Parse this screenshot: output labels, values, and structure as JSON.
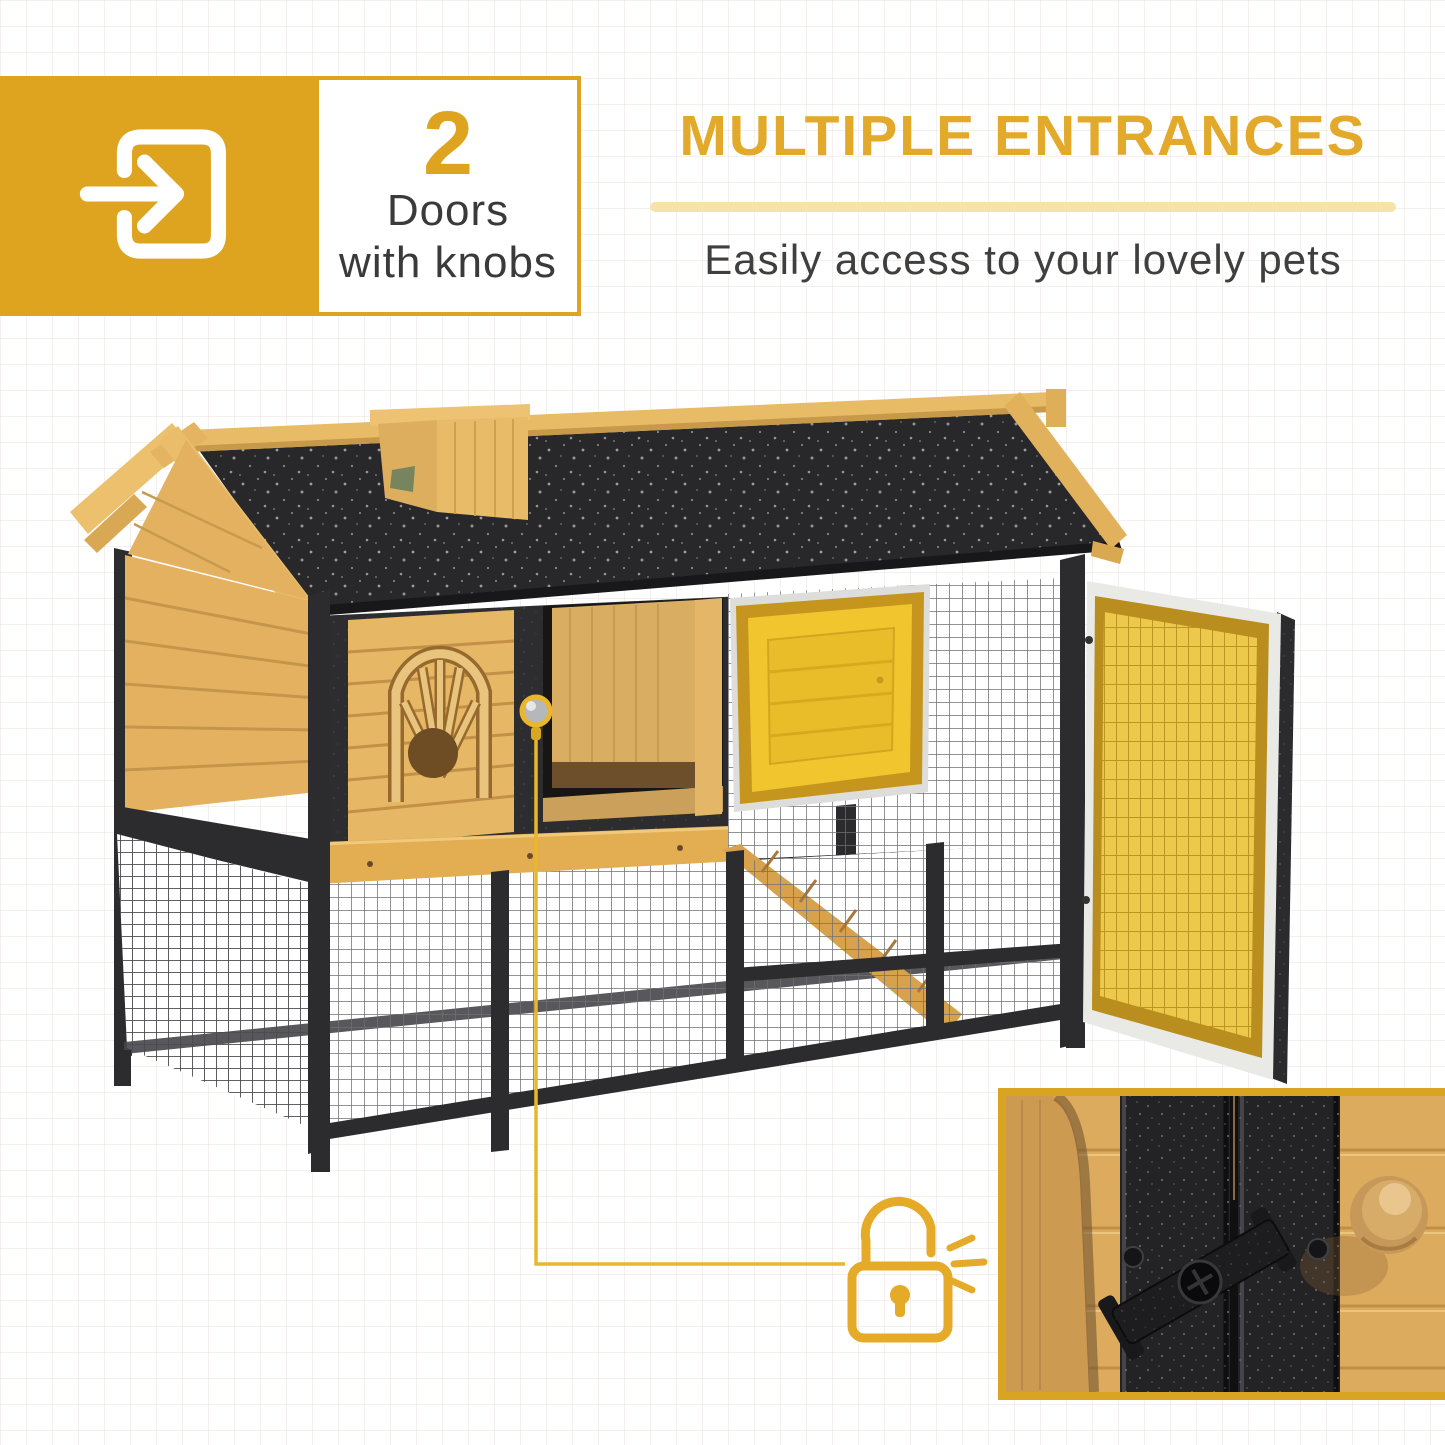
{
  "canvas": {
    "width": 1445,
    "height": 1445,
    "background": "#ffffff",
    "grid_line_color": "#eae4e0",
    "grid_size_px": 26
  },
  "feature_badge": {
    "icon": "door-enter-icon",
    "count": "2",
    "label_line1": "Doors",
    "label_line2": "with knobs",
    "box_color": "#dfa41f",
    "count_color": "#dfa41f",
    "text_color": "#3a3a3a"
  },
  "headline": {
    "title": "MULTIPLE ENTRANCES",
    "subtitle": "Easily access to your lovely pets",
    "title_color": "#e2a92b",
    "divider_color": "#f6e3aa",
    "subtitle_color": "#3f3f3f"
  },
  "product_photo": {
    "subject": "wooden-pet-hutch-with-run",
    "wood_color": "#e3b160",
    "roof_color": "#28282b",
    "metal_frame_color": "#2d2d30",
    "highlight_yellow": "#ecc94b",
    "highlighted_parts": [
      "open-mesh-side-door",
      "nest-box-door",
      "door-knob"
    ]
  },
  "callouts": {
    "knob_marker": "knob-marker",
    "lock_icon": "padlock-unlocked-icon",
    "lock_color": "#e4aa28",
    "leader_color": "#eab62c",
    "inset": "door-latch-closeup",
    "inset_border_color": "#d8a422"
  }
}
